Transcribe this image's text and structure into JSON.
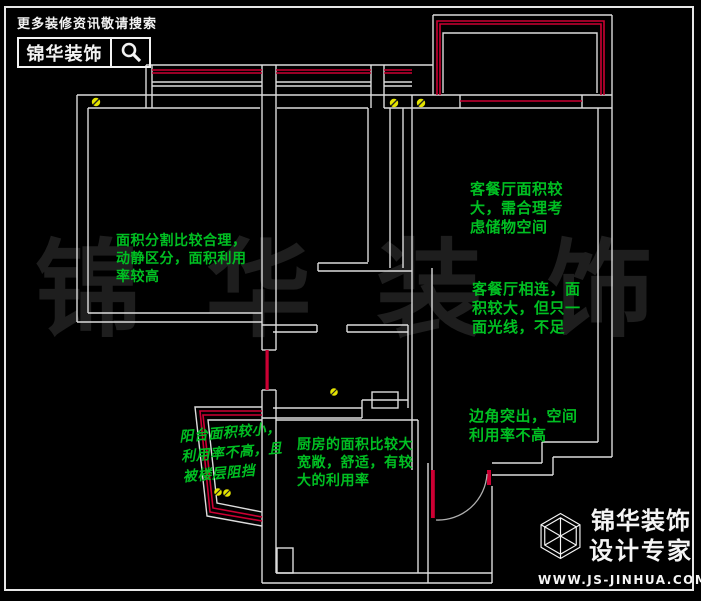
{
  "header": {
    "tagline": "更多装修资讯敬请搜索",
    "brand": "锦华装饰"
  },
  "watermark": {
    "characters": [
      "锦",
      "华",
      "装",
      "饰"
    ]
  },
  "annotations": [
    {
      "id": "bedroom",
      "text": "面积分割比较合理，\n动静区分，面积利用\n率较高"
    },
    {
      "id": "living-storage",
      "text": "客餐厅面积较\n大，需合理考\n虑储物空间"
    },
    {
      "id": "living-light",
      "text": "客餐厅相连，面\n积较大，但只一\n面光线，不足"
    },
    {
      "id": "corner",
      "text": "边角突出，空间\n利用率不高"
    },
    {
      "id": "balcony",
      "text": "阳台面积较小，\n利用率不高，且\n被楼层阻挡"
    },
    {
      "id": "kitchen",
      "text": "厨房的面积比较大\n宽敞，舒适，有较\n大的利用率"
    }
  ],
  "footer": {
    "brand_line1": "锦华装饰",
    "brand_line2": "设计专家",
    "website": "WWW.JS-JINHUA.COM"
  },
  "colors": {
    "background": "#000000",
    "wall_line": "#dcdcdc",
    "window_red": "#cc0033",
    "annotation_green": "#00bf22",
    "symbol_yellow": "#e4e400",
    "watermark_gray": "#1e1e1e"
  }
}
